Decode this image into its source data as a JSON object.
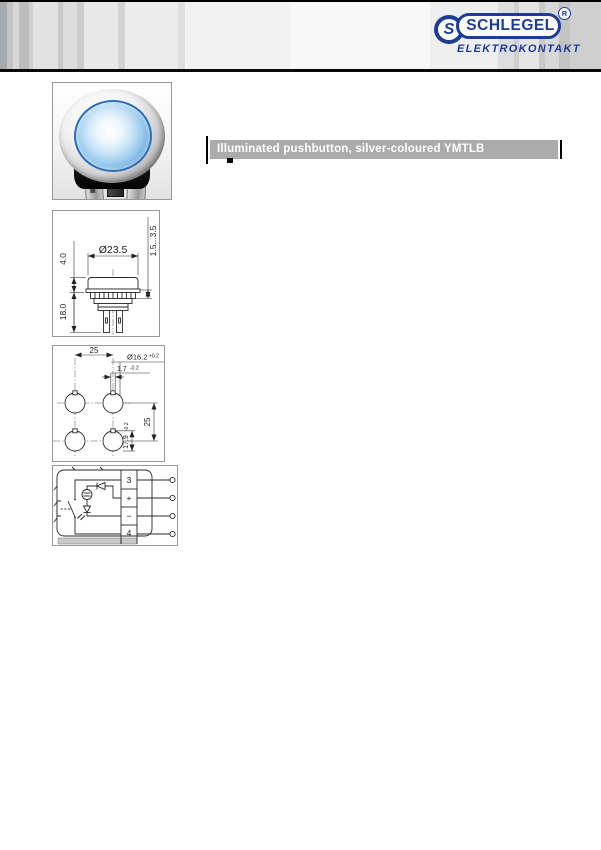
{
  "page": {
    "width": 601,
    "height": 850,
    "background": "#ffffff"
  },
  "header": {
    "brand": "SCHLEGEL",
    "brand_sub": "ELEKTROKONTAKT",
    "registered_mark": "R",
    "emblem_letter": "S",
    "brand_color": "#1d3c97"
  },
  "title_bar": {
    "text": "Illuminated pushbutton, silver-coloured YMTLB",
    "background": "#ababab",
    "text_color": "#ffffff"
  },
  "figures": {
    "product_photo": {
      "description": "illuminated pushbutton, silver bezel, blue lens",
      "lens_color": "#8fc4ec"
    },
    "dimension_drawing": {
      "diameter": "Ø23.5",
      "height_above_panel": "4.0",
      "depth_below_panel": "18.0",
      "panel_thickness_range": "1.5...3.5"
    },
    "drilling_plan": {
      "hole_pitch_horizontal": "25",
      "hole_pitch_vertical": "25",
      "hole_diameter": "Ø16.2",
      "hole_diameter_tolerance": "+0.2",
      "notch_width": "1.7",
      "notch_width_tolerance": "-0.2",
      "notch_dimension": "17.9",
      "notch_dimension_tolerance": "-0.2"
    },
    "circuit_diagram": {
      "terminals": [
        "3",
        "+",
        "−",
        "4"
      ]
    }
  }
}
